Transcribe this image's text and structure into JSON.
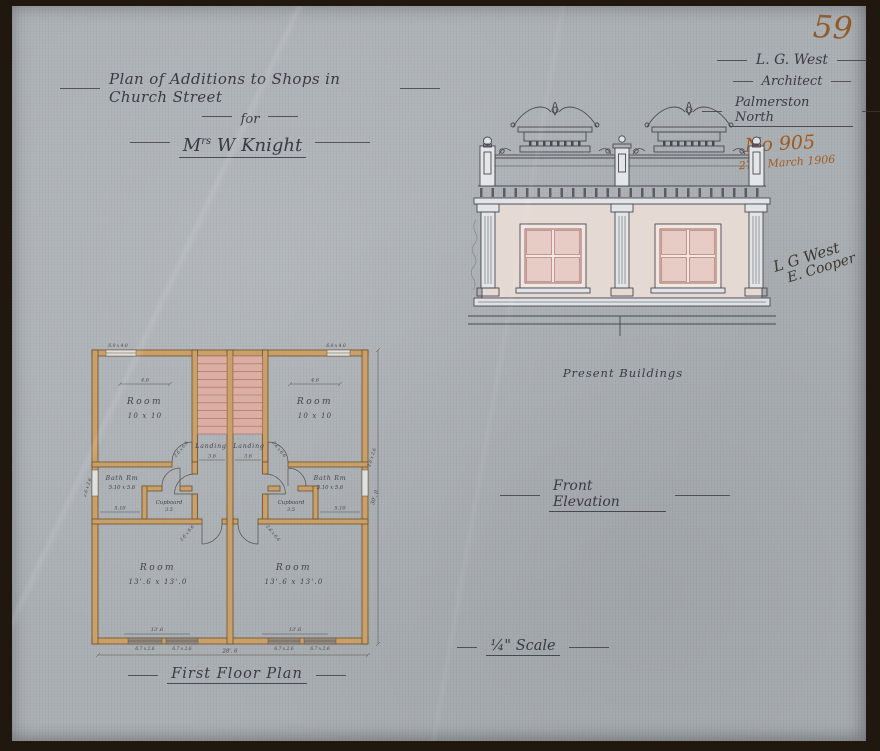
{
  "page_number": "59",
  "title_block": {
    "line1": "Plan of Additions to Shops in Church Street",
    "line2": "for",
    "line3_m": "M",
    "line3_sup": "rs",
    "line3_rest": " W Knight"
  },
  "architect_block": {
    "name": "L. G. West",
    "role": "Architect",
    "location": "Palmerston North",
    "drawing_number": "No 905",
    "date": "27th March 1906"
  },
  "signatures": {
    "architect": "L G West",
    "second": "E. Cooper"
  },
  "elevation": {
    "annotation": "Present Buildings",
    "caption": "Front Elevation"
  },
  "plan": {
    "caption": "First Floor Plan",
    "room_top_left": {
      "label": "Room",
      "size": "10 x 10"
    },
    "room_top_right": {
      "label": "Room",
      "size": "10 x 10"
    },
    "landing_left": "Landing",
    "landing_right": "Landing",
    "bath_left": {
      "label": "Bath Rm",
      "size": "5.10 x 5.6"
    },
    "bath_right": {
      "label": "Bath Rm",
      "size": "5.10 x 5.6"
    },
    "cupboard_left": {
      "label": "Cupboard",
      "size": "3.5"
    },
    "cupboard_right": {
      "label": "Cupboard",
      "size": "3.5"
    },
    "room_bottom_left": {
      "label": "Room",
      "size": "13'.6 x 13'.0"
    },
    "room_bottom_right": {
      "label": "Room",
      "size": "13'.6 x 13'.0"
    },
    "dims": {
      "window_top": "6.0 x 4.0",
      "top_room": "4.6",
      "landing": "3.6",
      "bath": "5.10",
      "bottom_room": "13'.6",
      "window_bottom": "6.7 x 2.6",
      "overall_width": "28'. 6",
      "overall_height": "30'. 0",
      "side_window": "2.6 x 2.6",
      "door": "2.6 x 6.6"
    }
  },
  "scale_caption": "¼\" Scale",
  "colors": {
    "paper": "#aaafb4",
    "frame": "#20180f",
    "ink": "#3c3944",
    "orange_ink": "#a15a1e",
    "wall_fill": "#c9a06a",
    "stair_fill": "#dbaea4",
    "elevation_wall": "#e5d9d3",
    "window_pane": "#e7ccc5"
  }
}
